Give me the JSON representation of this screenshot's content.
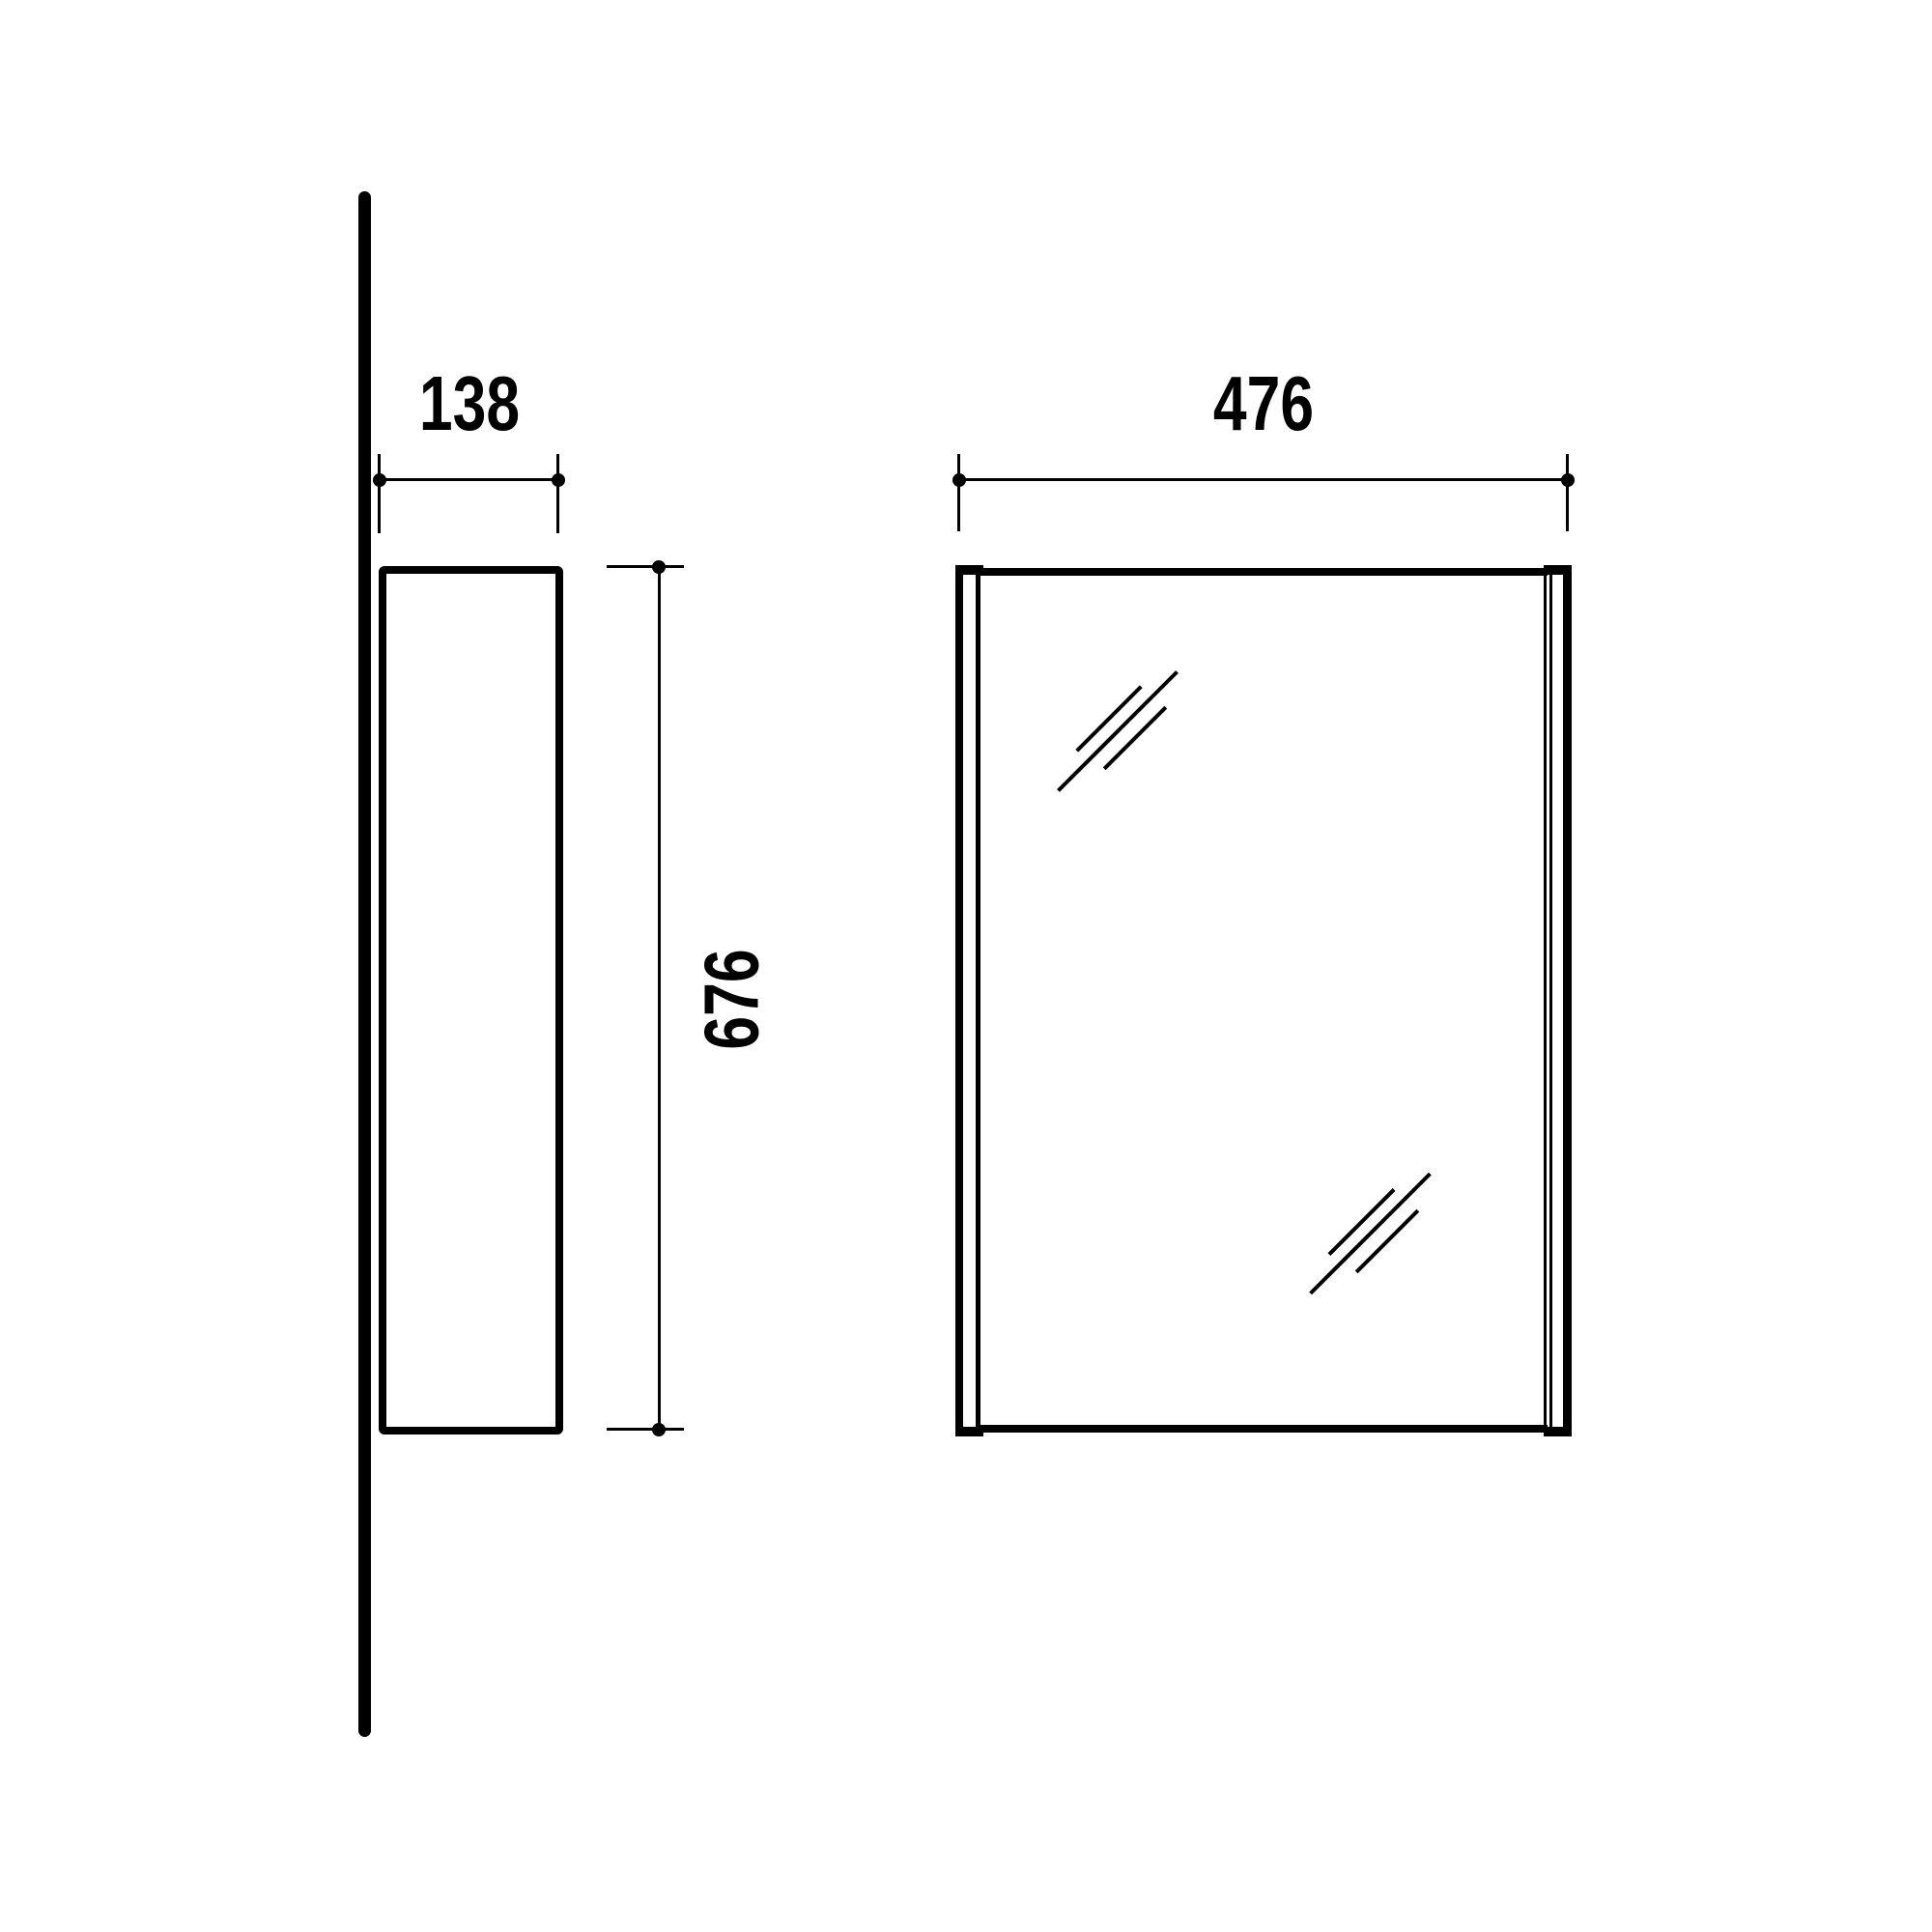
{
  "drawing": {
    "background_color": "#ffffff",
    "line_color": "#000000",
    "views": {
      "side": {
        "title": "side-profile-view",
        "depth_dimension": {
          "value": "138"
        },
        "height_dimension": {
          "value": "676"
        }
      },
      "front": {
        "title": "front-view",
        "width_dimension": {
          "value": "476"
        }
      }
    }
  }
}
